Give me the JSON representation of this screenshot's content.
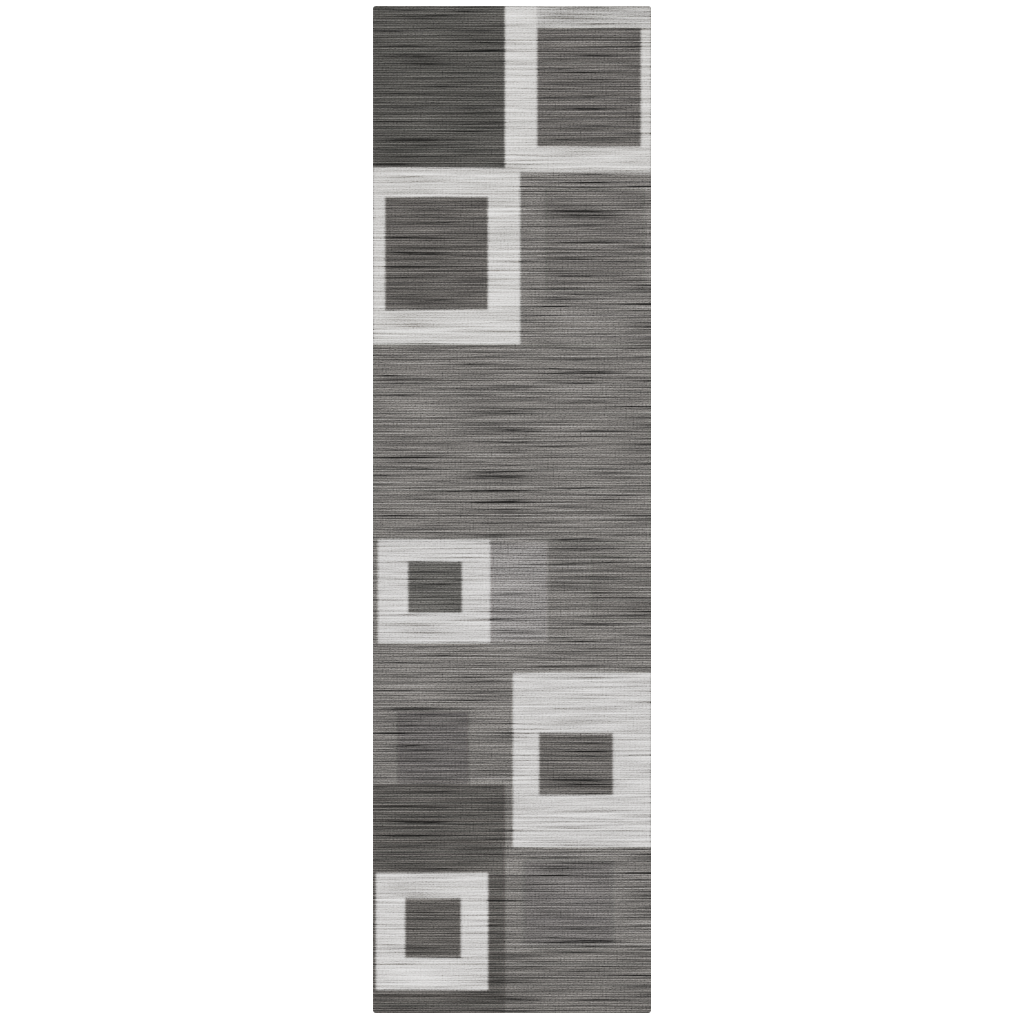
{
  "scene": {
    "description": "Product photograph of a charcoal gray runner rug with an abstract geometric pattern of squares-within-squares, shown flat on a plain white background",
    "background_color": "#ffffff"
  },
  "rug": {
    "left": 373,
    "top": 6,
    "width": 278,
    "height": 1007,
    "base_color": "#565452",
    "palette": {
      "dark_charcoal": "#3b3a38",
      "inner_square_dark": "#4a4846",
      "medium_heather_gray": "#565452",
      "light_silver": "#b3b1ae"
    },
    "blocks": [
      {
        "name": "top-left-dark-block",
        "x": 0,
        "y": 0,
        "w": 132,
        "h": 163,
        "color": "#3b3a38",
        "opacity": 1
      },
      {
        "name": "top-right-light-frame",
        "x": 132,
        "y": 0,
        "w": 146,
        "h": 166,
        "color": "#b3b1ae",
        "opacity": 1
      },
      {
        "name": "top-right-top-strip",
        "x": 164,
        "y": 0,
        "w": 114,
        "h": 24,
        "color": "#8d8b88",
        "opacity": 1
      },
      {
        "name": "top-right-inner-dark-square",
        "x": 164,
        "y": 22,
        "w": 104,
        "h": 119,
        "color": "#4a4846",
        "opacity": 1
      },
      {
        "name": "mid-left-light-frame",
        "x": 0,
        "y": 162,
        "w": 147,
        "h": 176,
        "color": "#b2b0ad",
        "opacity": 1
      },
      {
        "name": "mid-left-inner-dark-square",
        "x": 12,
        "y": 191,
        "w": 103,
        "h": 113,
        "color": "#454341",
        "opacity": 1
      },
      {
        "name": "upper-right-faint-dark-square",
        "x": 172,
        "y": 182,
        "w": 100,
        "h": 104,
        "color": "#3b3a38",
        "opacity": 0.3
      },
      {
        "name": "center-field-shade",
        "x": 0,
        "y": 338,
        "w": 278,
        "h": 200,
        "color": "#504e4c",
        "opacity": 0.3
      },
      {
        "name": "small-light-square",
        "x": 5,
        "y": 534,
        "w": 112,
        "h": 103,
        "color": "#aeacaa",
        "opacity": 1
      },
      {
        "name": "small-light-inner-dark-square",
        "x": 35,
        "y": 556,
        "w": 54,
        "h": 51,
        "color": "#444341",
        "opacity": 1
      },
      {
        "name": "small-square-right-faint-light",
        "x": 117,
        "y": 534,
        "w": 58,
        "h": 103,
        "color": "#7b7977",
        "opacity": 0.4
      },
      {
        "name": "mid-right-faint-dark-square",
        "x": 218,
        "y": 550,
        "w": 60,
        "h": 64,
        "color": "#3b3a38",
        "opacity": 0.22
      },
      {
        "name": "lower-left-faint-dark-square",
        "x": 24,
        "y": 705,
        "w": 72,
        "h": 80,
        "color": "#363534",
        "opacity": 0.4
      },
      {
        "name": "lower-right-light-block",
        "x": 140,
        "y": 667,
        "w": 138,
        "h": 174,
        "color": "#aeacaa",
        "opacity": 1
      },
      {
        "name": "lower-right-inner-dark-square",
        "x": 166,
        "y": 727,
        "w": 74,
        "h": 62,
        "color": "#4a4846",
        "opacity": 1
      },
      {
        "name": "bottom-left-dark-block",
        "x": 0,
        "y": 778,
        "w": 132,
        "h": 229,
        "color": "#403e3c",
        "opacity": 1
      },
      {
        "name": "bottom-left-light-frame",
        "x": 3,
        "y": 867,
        "w": 112,
        "h": 117,
        "color": "#b4b2b0",
        "opacity": 1
      },
      {
        "name": "bottom-left-inner-dark-square",
        "x": 32,
        "y": 892,
        "w": 56,
        "h": 60,
        "color": "#444240",
        "opacity": 1
      },
      {
        "name": "bottom-right-faint-dark-square",
        "x": 150,
        "y": 854,
        "w": 90,
        "h": 86,
        "color": "#3b3a38",
        "opacity": 0.28
      },
      {
        "name": "bottom-right-bottom-shade",
        "x": 132,
        "y": 945,
        "w": 146,
        "h": 62,
        "color": "#474543",
        "opacity": 0.5
      }
    ]
  }
}
